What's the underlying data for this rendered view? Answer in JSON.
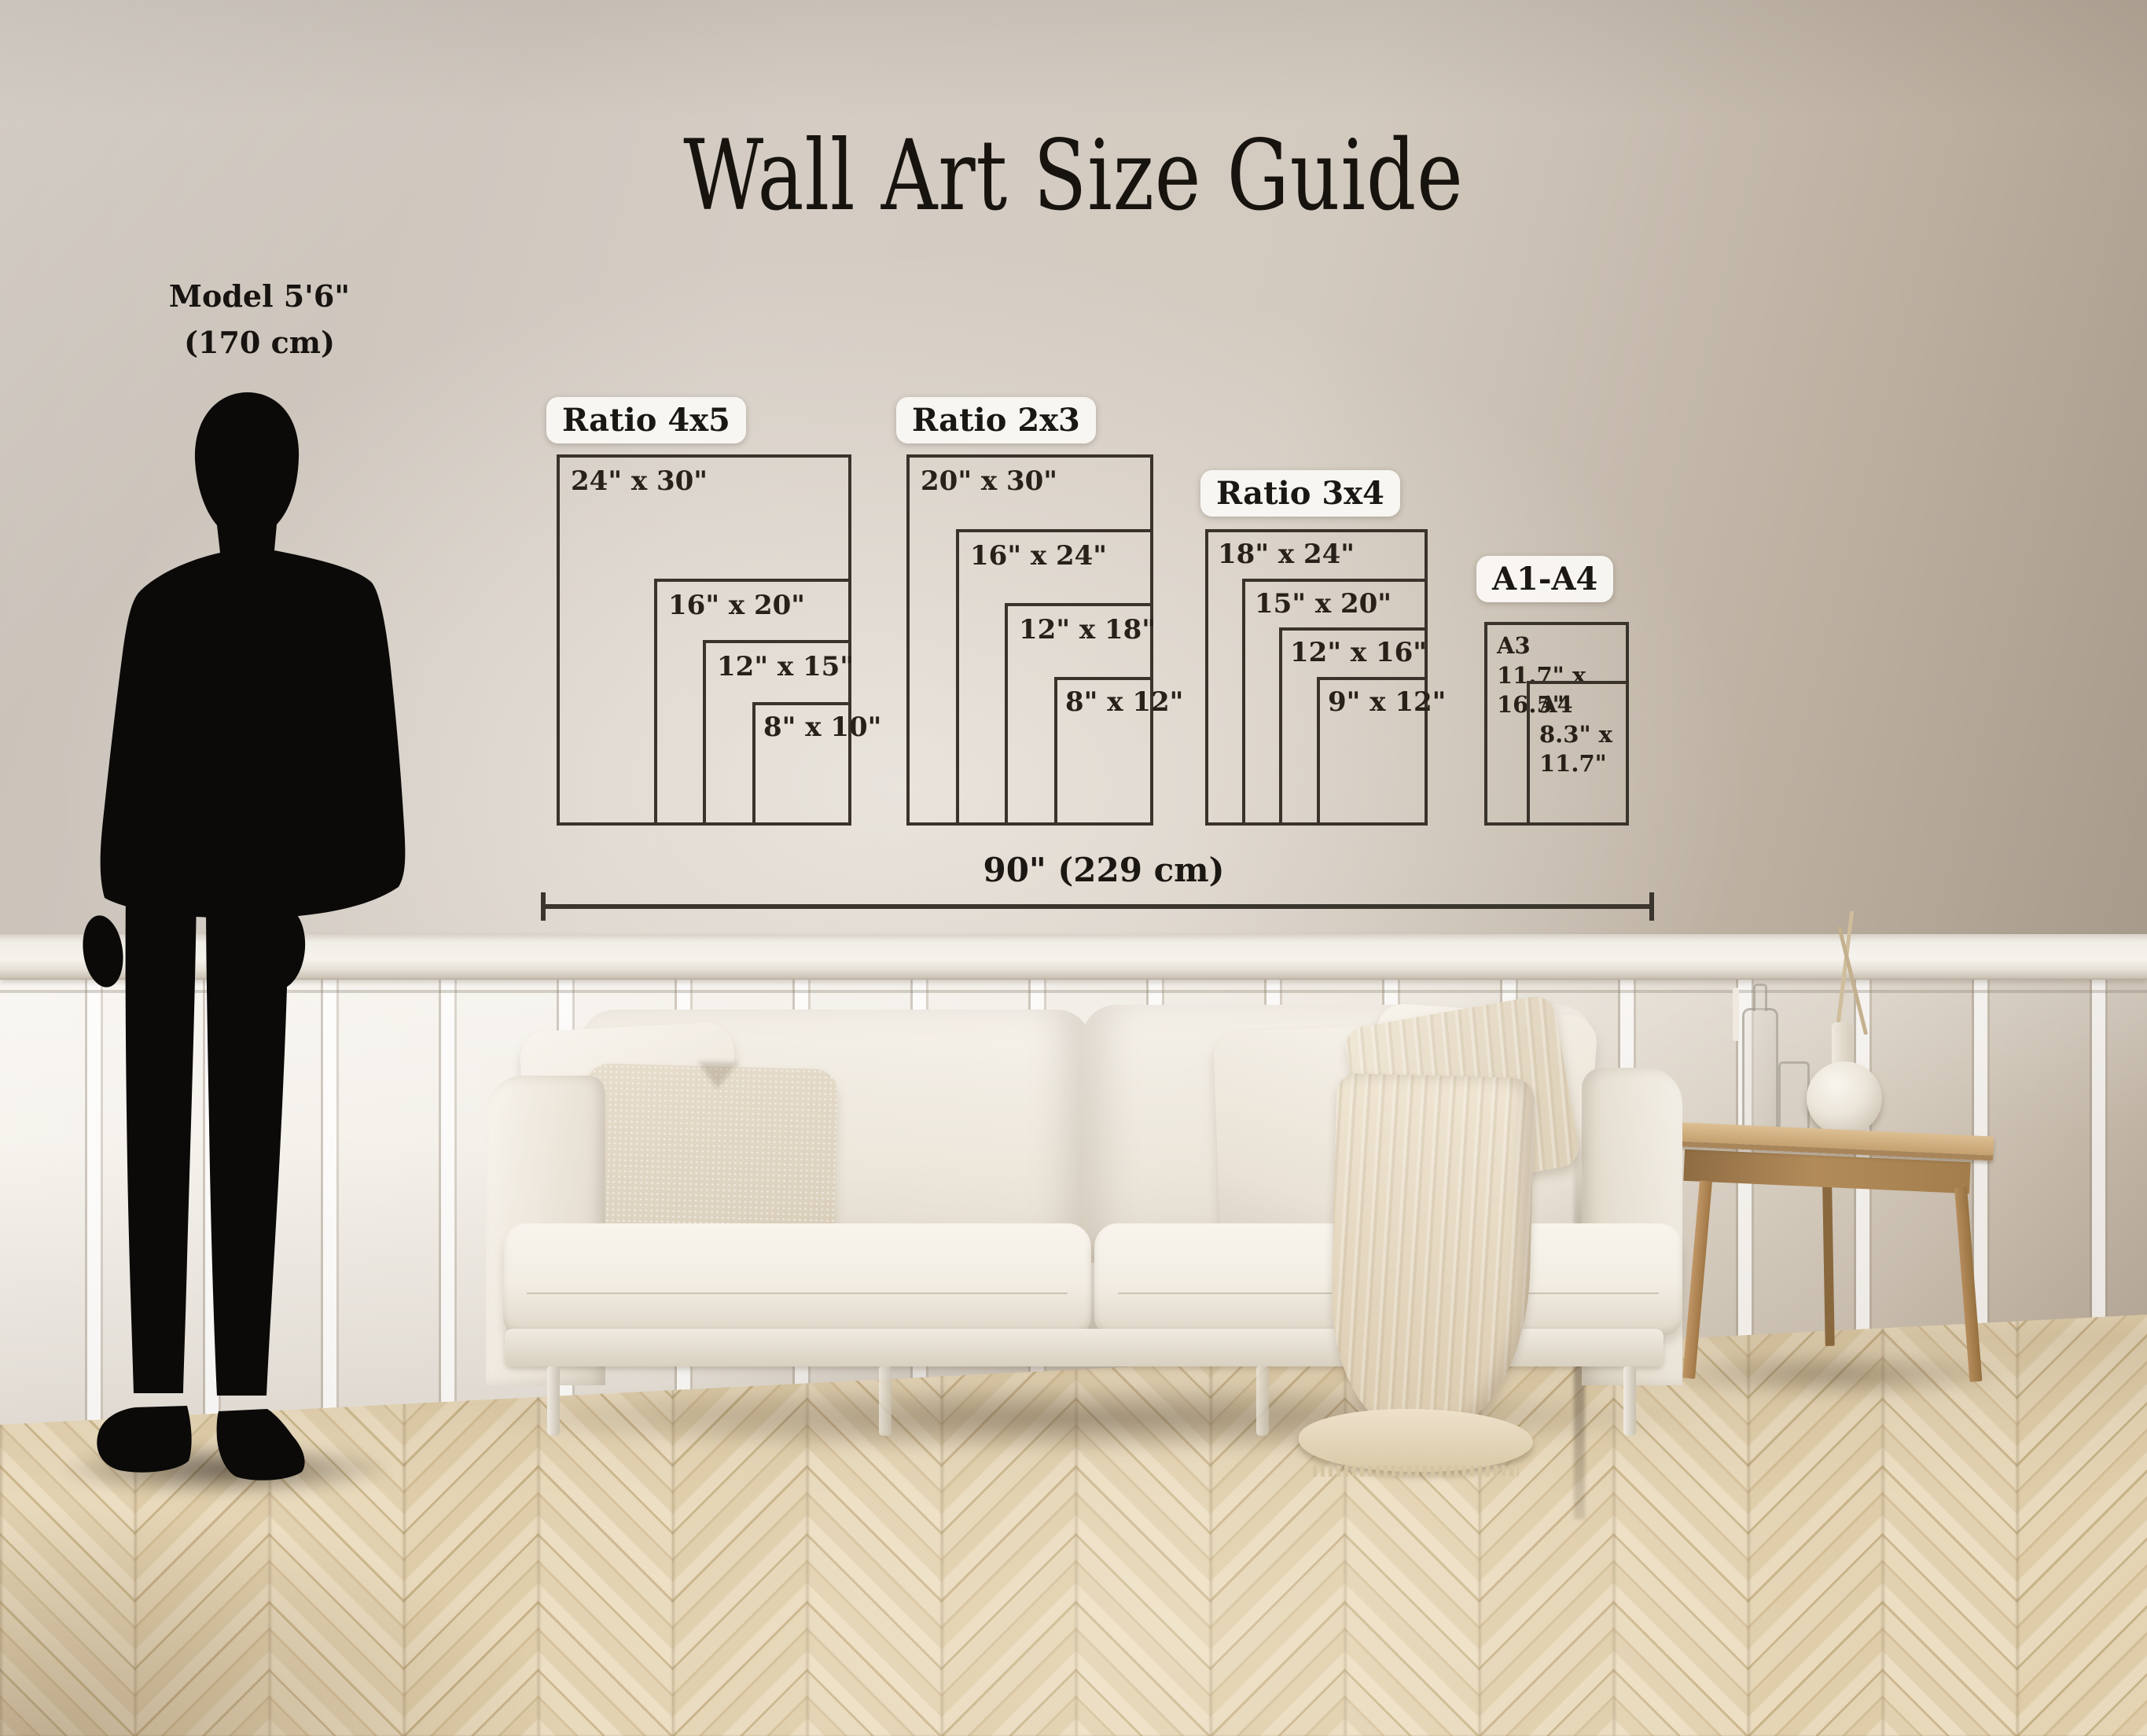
{
  "title": "Wall Art Size Guide",
  "model": {
    "line1": "Model 5'6\"",
    "line2": "(170 cm)"
  },
  "ruler": {
    "label": "90\" (229 cm)"
  },
  "groups": [
    {
      "id": "ratio-4x5",
      "label": "Ratio 4x5",
      "sizes": [
        "24\" x 30\"",
        "16\" x 20\"",
        "12\" x 15\"",
        "8\" x 10\""
      ]
    },
    {
      "id": "ratio-2x3",
      "label": "Ratio 2x3",
      "sizes": [
        "20\" x 30\"",
        "16\" x 24\"",
        "12\" x 18\"",
        "8\" x 12\""
      ]
    },
    {
      "id": "ratio-3x4",
      "label": "Ratio 3x4",
      "sizes": [
        "18\" x 24\"",
        "15\" x 20\"",
        "12\" x 16\"",
        "9\" x 12\""
      ]
    },
    {
      "id": "a-series",
      "label": "A1-A4",
      "a3_name": "A3",
      "a3_size": "11.7\" x 16.5\"",
      "a4_name": "A4",
      "a4_size_l1": "8.3\" x",
      "a4_size_l2": "11.7\""
    }
  ],
  "palette": {
    "line": "#39332b",
    "pill_bg": "#f8f5f0",
    "text": "#1b1712",
    "wall": "#cfc7be",
    "wainscot": "#f2eee7",
    "floor_light": "#e9dabd",
    "floor_dark": "#cdb890",
    "sofa": "#f4f0e8",
    "throw": "#e9dcc4",
    "wood": "#c49a69"
  }
}
